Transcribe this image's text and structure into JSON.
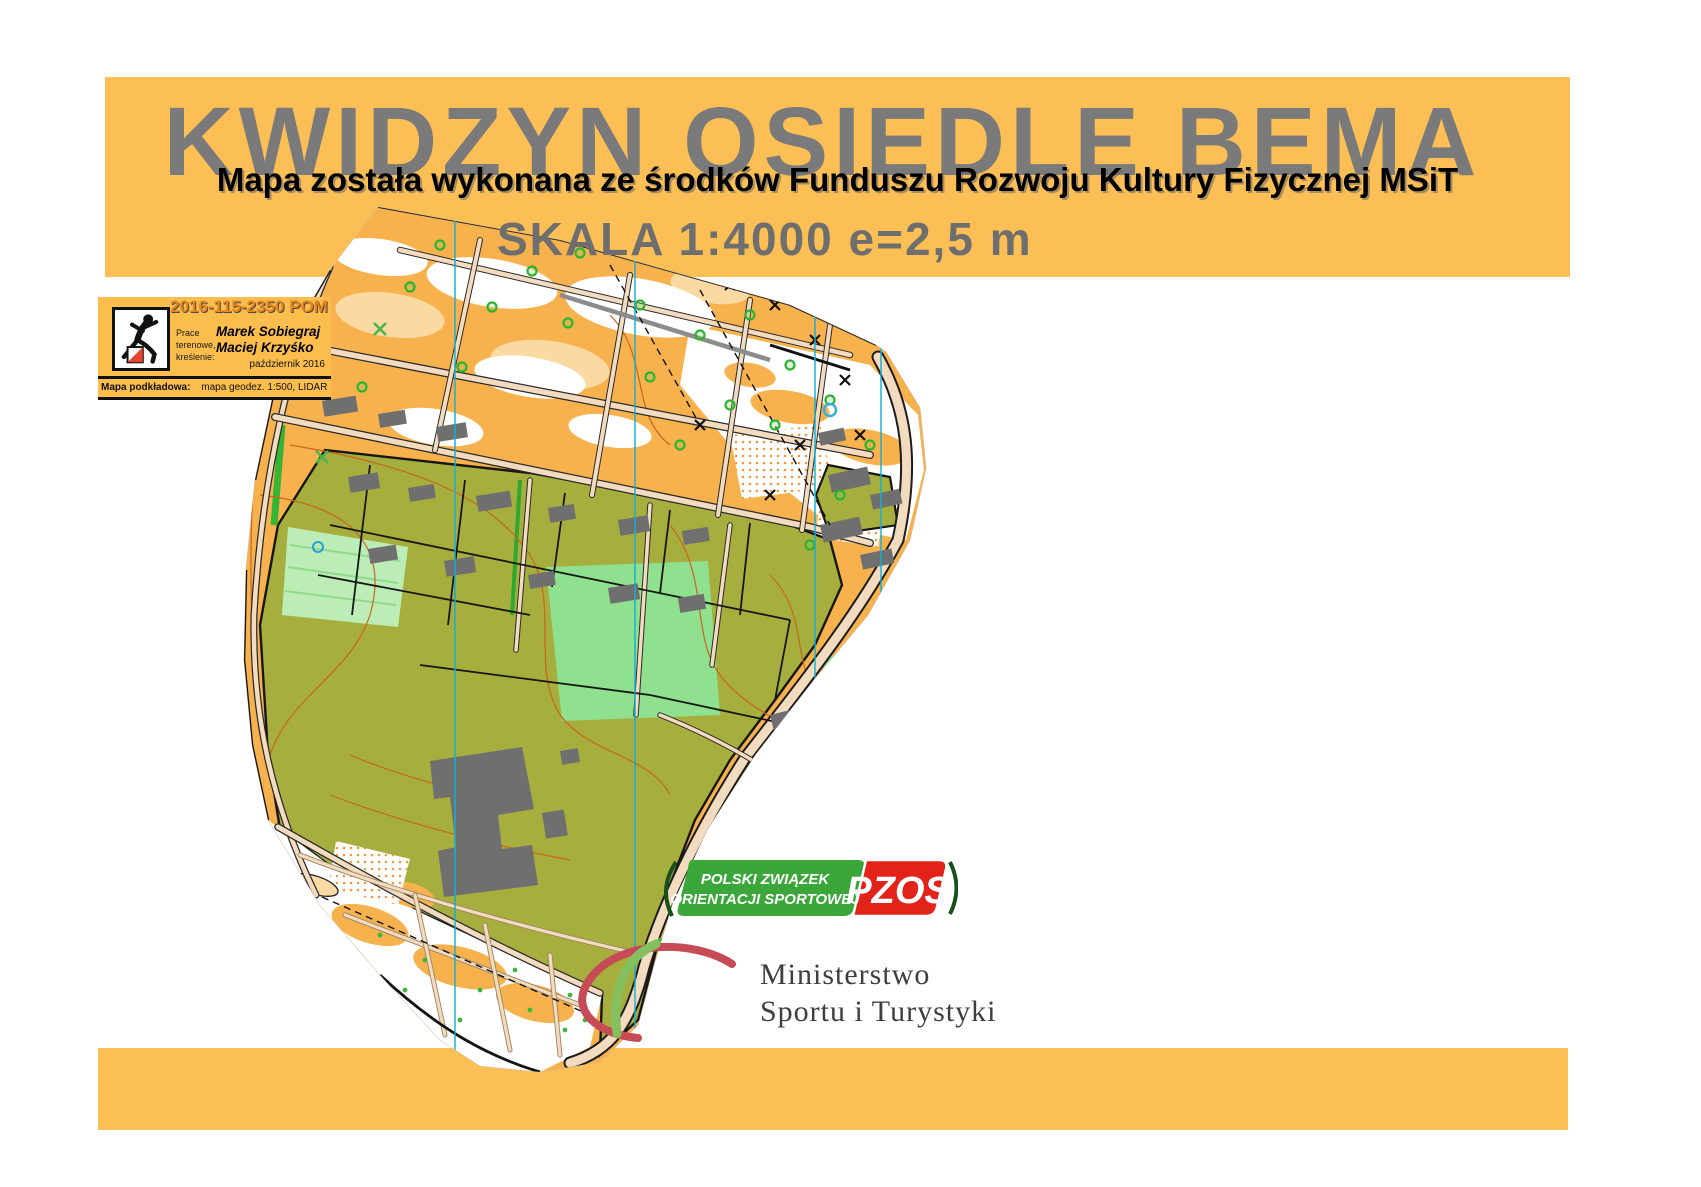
{
  "header": {
    "title": "KWIDZYN OSIEDLE BEMA",
    "subtitle": "Mapa została wykonana ze środków Funduszu Rozwoju Kultury Fizycznej MSiT",
    "scale_line": "SKALA  1:4000 e=2,5 m"
  },
  "credits_box": {
    "map_id": "2016-115-2350 POM",
    "work_label_lines": [
      "Prace",
      "terenowe,",
      "kreślenie:"
    ],
    "authors": [
      "Marek Sobiegraj",
      "Maciej Krzyśko"
    ],
    "date": "październik 2016",
    "base_map_label": "Mapa podkładowa:",
    "base_map_value": "mapa geodez. 1:500, LIDAR"
  },
  "logos": {
    "pzos": {
      "line1": "POLSKI ZWIĄZEK",
      "line2": "ORIENTACJI SPORTOWEJ",
      "acronym": "PZOS",
      "green": "#3BA63A",
      "red": "#E2231A"
    },
    "ministry": {
      "line1": "Ministerstwo",
      "line2": "Sportu i Turystyki"
    }
  },
  "colors": {
    "band_orange": "#FCBF55",
    "title_gray": "#7A7A7A",
    "map_open_orange": "#F7B24E",
    "map_pale_orange": "#FBD9A2",
    "map_olive_green": "#A6AE3E",
    "map_lawn_green": "#8FE08F",
    "map_building_gray": "#6F6F6F",
    "map_road_beige": "#F2DBBF",
    "north_line_cyan": "#14B0D4"
  }
}
